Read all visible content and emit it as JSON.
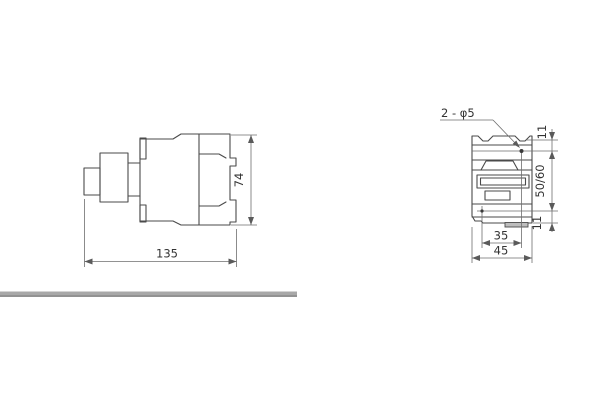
{
  "drawing": {
    "title_hint": "contactor outline and mounting dimensions",
    "side_view": {
      "width_dim": "135",
      "height_dim": "74"
    },
    "front_view": {
      "holes_label": "2 - φ5",
      "top_offset_dim": "11",
      "vertical_pitch_dim": "50/60",
      "bottom_offset_dim": "11",
      "horizontal_pitch_dim": "35",
      "width_dim": "45"
    }
  },
  "colors": {
    "outline": "#4a4a4a",
    "dimension": "#6e6e6e",
    "arrow": "#5a5a5a",
    "text": "#333333",
    "hole": "#3a3a3a",
    "tab_fill": "#bdbdbd",
    "divider_bar": "#a8a8a8",
    "background": "#ffffff"
  }
}
